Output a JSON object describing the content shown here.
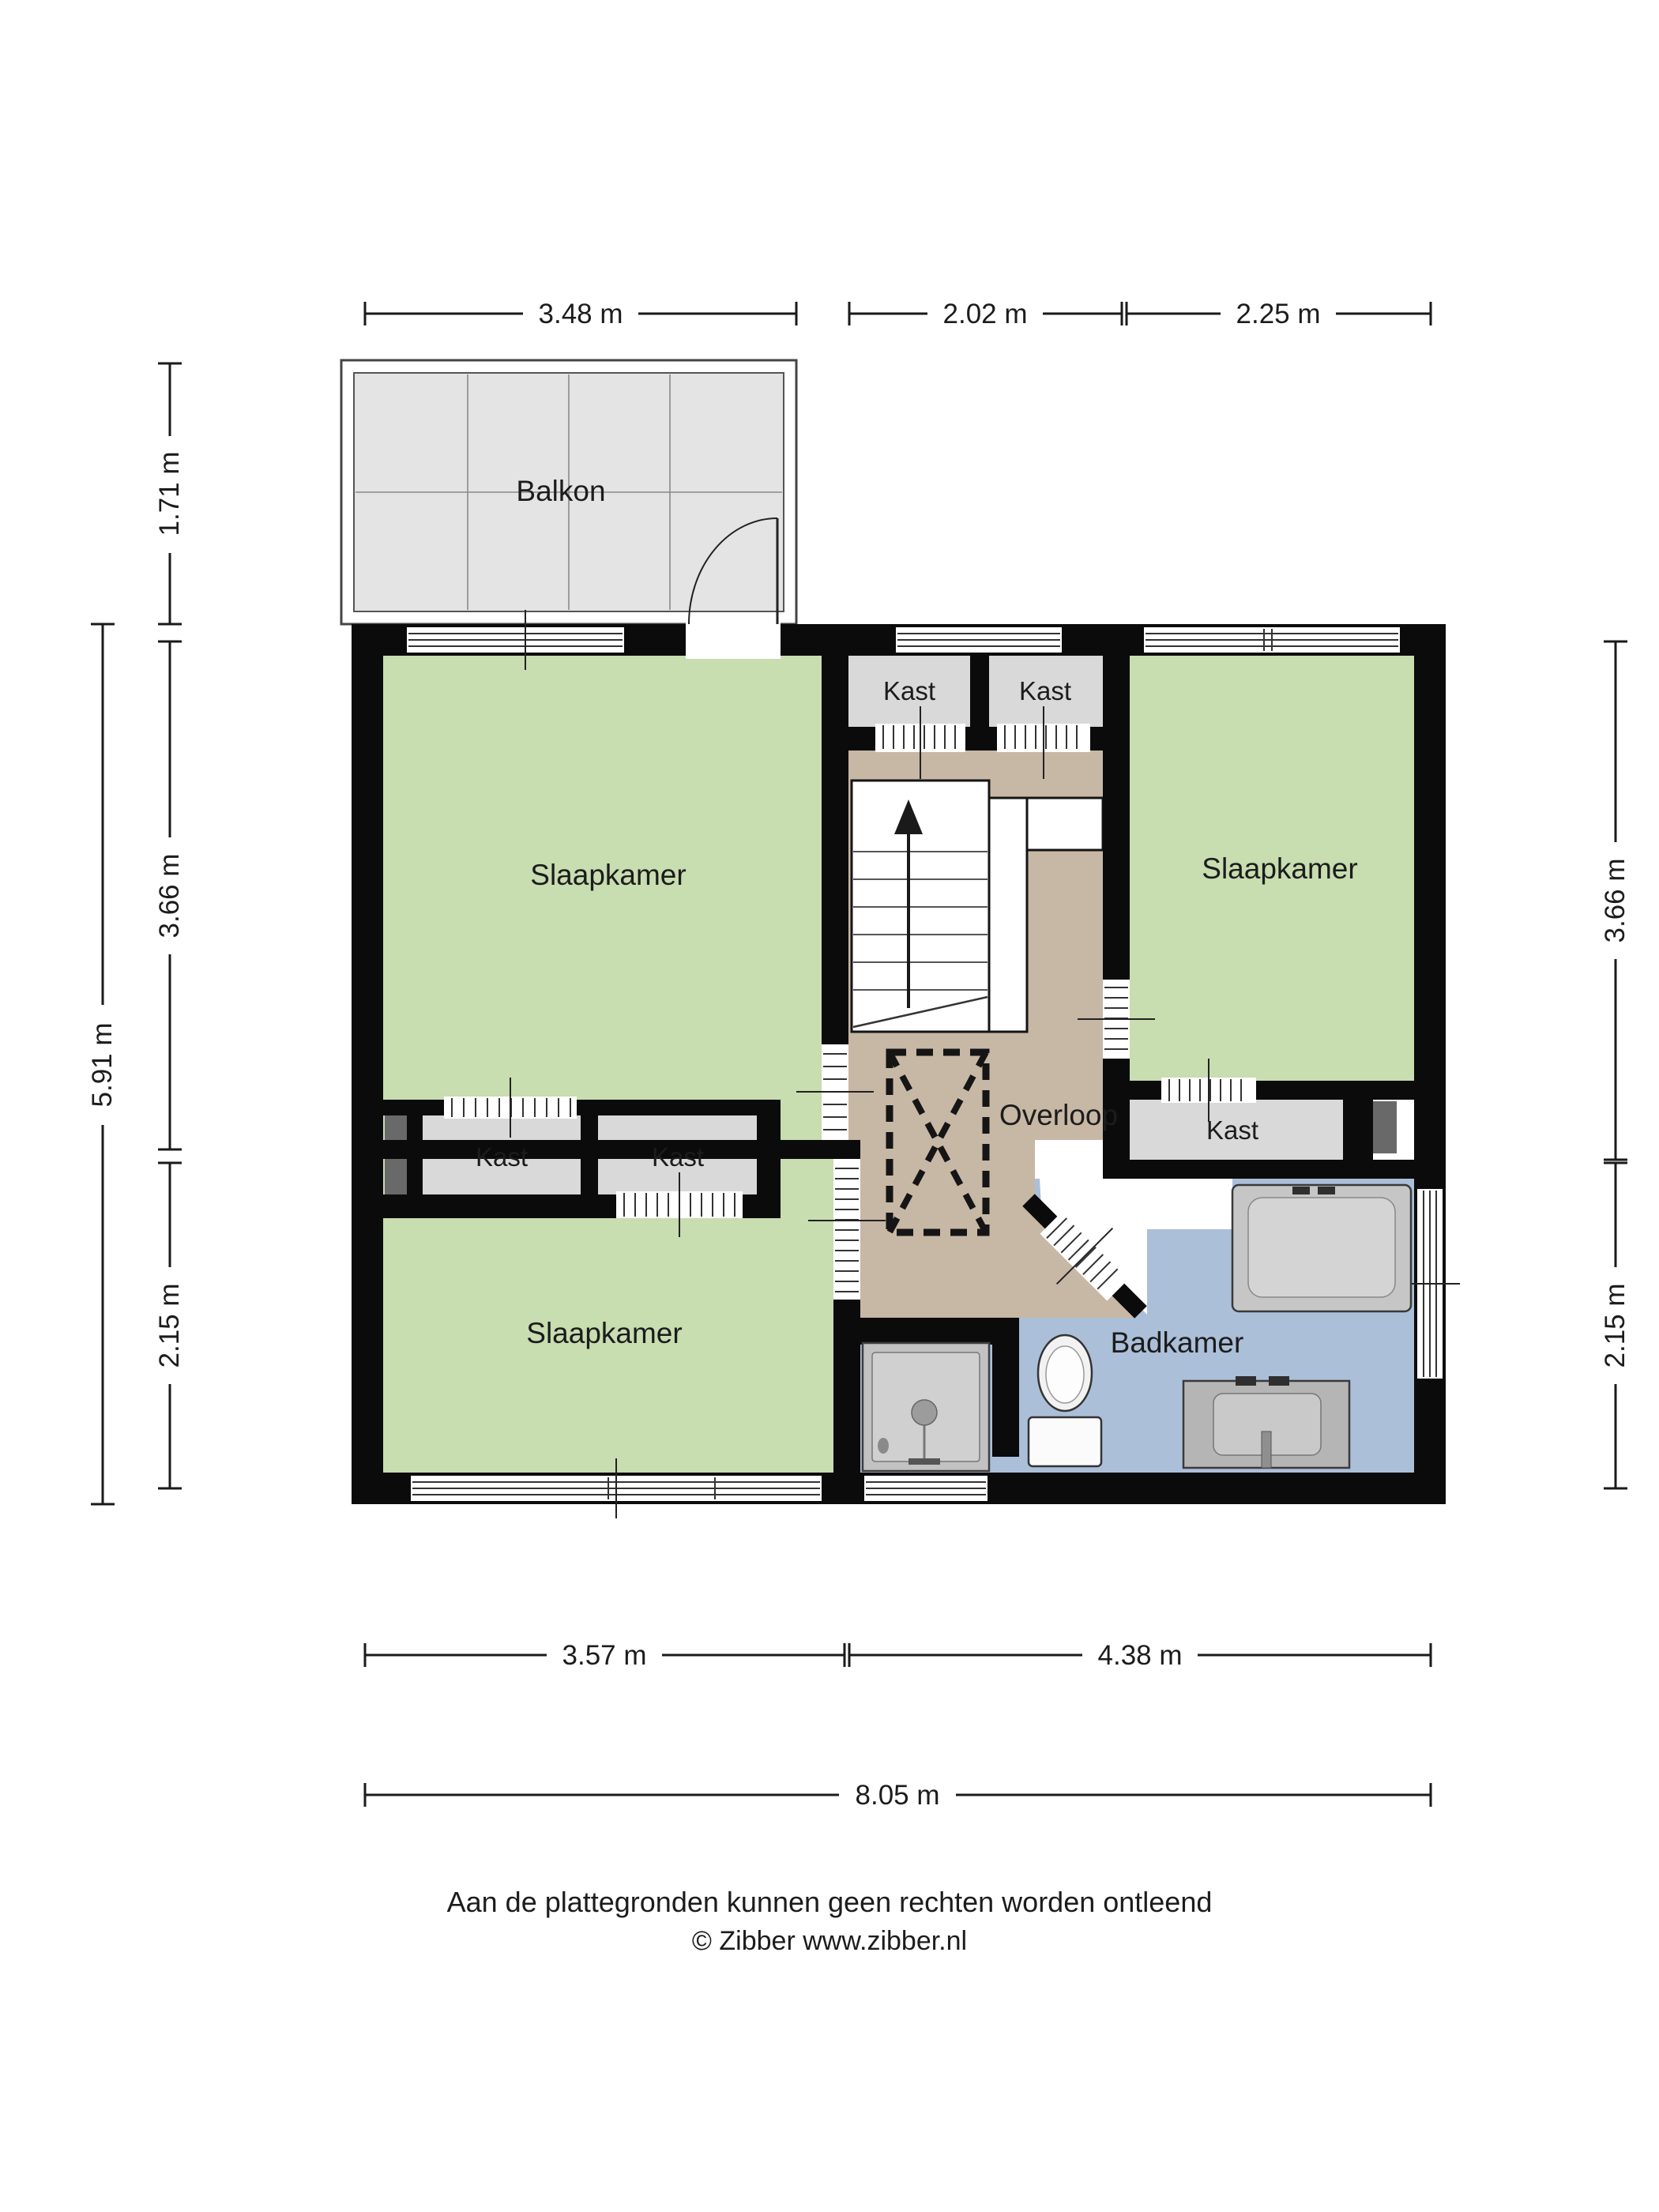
{
  "plan": {
    "labels": {
      "balcony": "Balkon",
      "bedroom_top_left": "Slaapkamer",
      "bedroom_top_right": "Slaapkamer",
      "bedroom_bottom_left": "Slaapkamer",
      "landing": "Overloop",
      "bathroom": "Badkamer",
      "closet_mid_top_1": "Kast",
      "closet_mid_top_2": "Kast",
      "closet_left_1": "Kast",
      "closet_left_2": "Kast",
      "closet_right": "Kast"
    },
    "dimensions": {
      "top": [
        "3.48 m",
        "2.02 m",
        "2.25 m"
      ],
      "left_outer": "5.91 m",
      "left": [
        "1.71 m",
        "3.66 m",
        "2.15 m"
      ],
      "right": [
        "3.66 m",
        "2.15 m"
      ],
      "bottom": [
        "3.57 m",
        "4.38 m"
      ],
      "bottom_total": "8.05 m"
    },
    "footer": {
      "disclaimer": "Aan de plattegronden kunnen geen rechten worden ontleend",
      "credit": "© Zibber www.zibber.nl"
    },
    "colors": {
      "bedroom": "#c8ddb0",
      "landing": "#c7b7a5",
      "bathroom": "#abbfd8",
      "balcony_floor": "#e4e4e4",
      "closet": "#d9d9d9",
      "shaft": "#696969",
      "wall": "#0b0b0b"
    }
  }
}
